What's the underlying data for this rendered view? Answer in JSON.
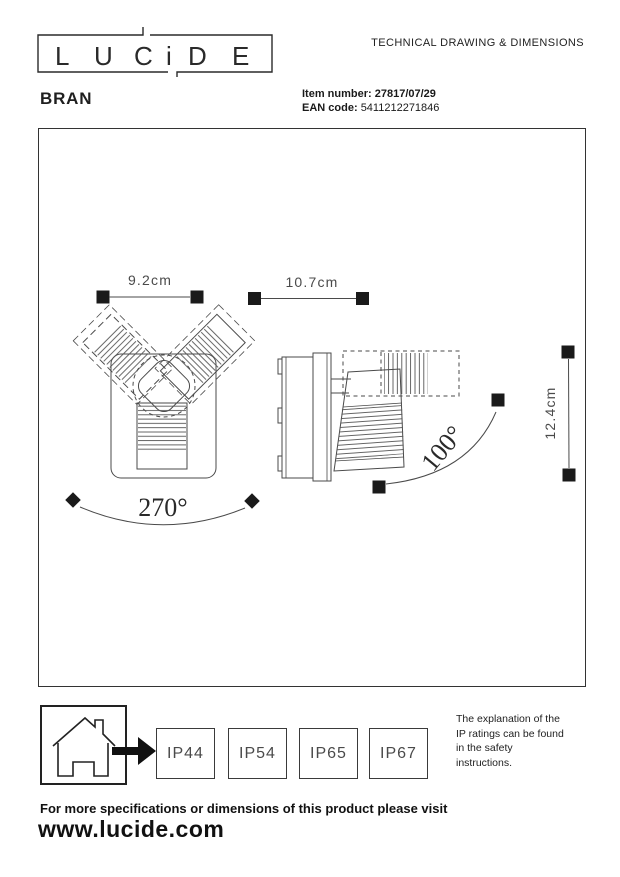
{
  "header": {
    "logo_letters": [
      "L",
      "U",
      "C",
      "i",
      "D",
      "E"
    ],
    "doc_title": "TECHNICAL DRAWING & DIMENSIONS",
    "product_name": "BRAN",
    "item_number_label": "Item number:",
    "item_number": "27817/07/29",
    "ean_label": "EAN code:",
    "ean": "5411212271846"
  },
  "drawing": {
    "dim_front_width": "9.2cm",
    "dim_side_width": "10.7cm",
    "dim_height": "12.4cm",
    "angle_pan": "270°",
    "angle_tilt": "100°"
  },
  "ip": {
    "ratings": [
      "IP44",
      "IP54",
      "IP65",
      "IP67"
    ],
    "note_lines": [
      "The explanation of the",
      "IP ratings can be found",
      "in the safety",
      "instructions."
    ]
  },
  "footer": {
    "line1": "For more specifications or dimensions of this product please visit",
    "website": "www.lucide.com"
  },
  "colors": {
    "ink": "#1f1f1f",
    "line_gray": "#4a4a4a",
    "marker_black": "#1a1a1a"
  }
}
